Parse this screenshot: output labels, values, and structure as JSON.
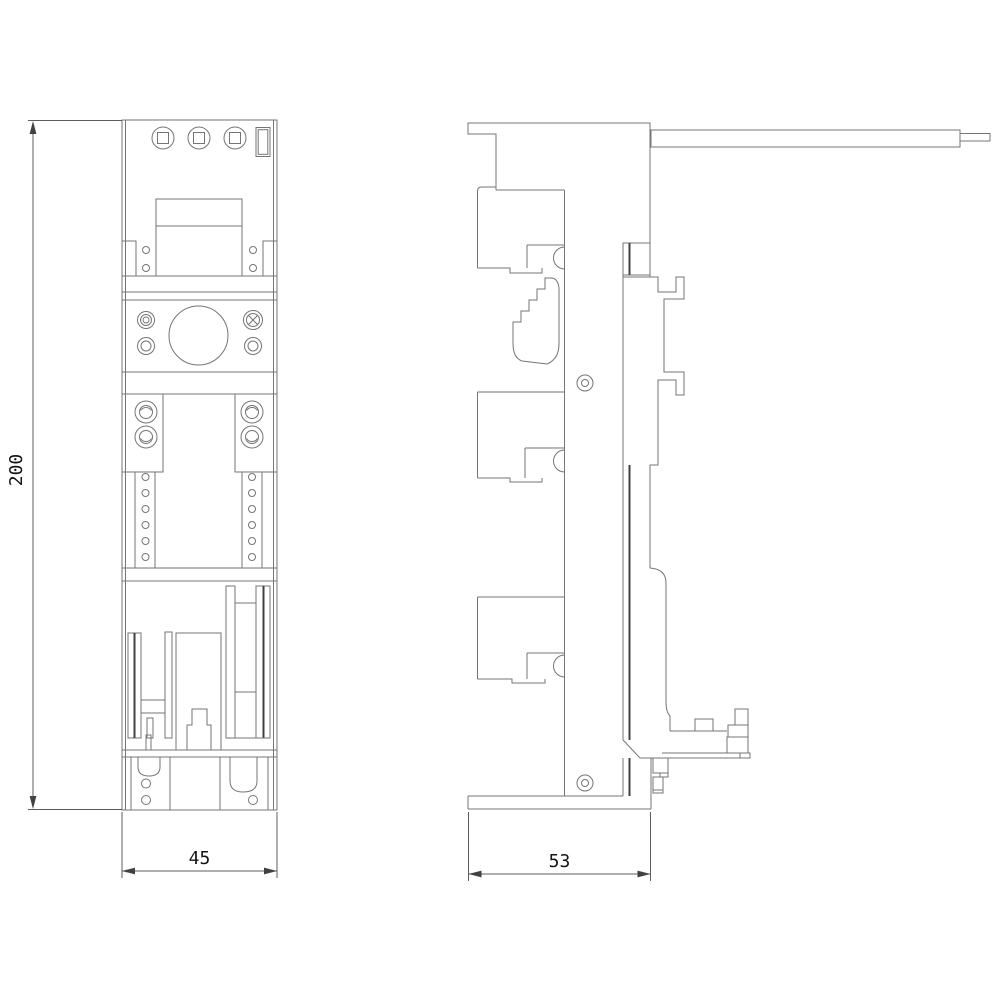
{
  "drawing": {
    "type": "technical-dimension-drawing",
    "background_color": "#ffffff",
    "line_color": "#757575",
    "dark_line_color": "#414141",
    "dimension_color": "#5c5c5c",
    "text_color": "#141414",
    "dimensions": {
      "overall_height": {
        "value": "200"
      },
      "front_width": {
        "value": "45"
      },
      "side_depth": {
        "value": "53"
      }
    }
  }
}
